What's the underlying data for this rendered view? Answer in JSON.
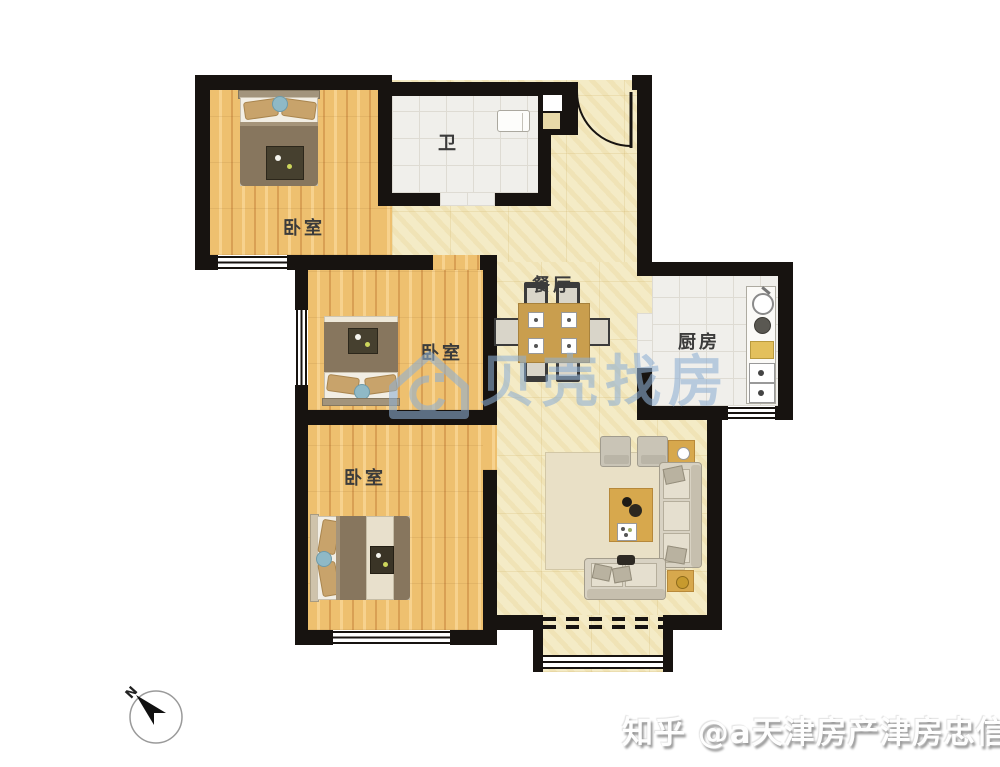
{
  "title": "三室户型图",
  "rooms": {
    "bedroom_top": {
      "label": "卧室"
    },
    "bedroom_mid": {
      "label": "卧室"
    },
    "bedroom_bottom": {
      "label": "卧室"
    },
    "bathroom": {
      "label": "卫"
    },
    "dining": {
      "label": "餐厅"
    },
    "kitchen": {
      "label": "厨房"
    }
  },
  "watermarks": {
    "center_logo_text": "贝壳找房",
    "bottom_right": "知乎 @a天津房产津房忠信庄"
  },
  "compass": {
    "label": "N"
  },
  "colors": {
    "wall": "#171310",
    "pale": "#f4ebc6",
    "wood": "#eec06f",
    "woodLight": "#f7d28e",
    "woodDark": "#d9a054",
    "tile": "#f0efeb",
    "tileLine": "#dedbd3",
    "label": "#3b3b3b",
    "wmBlue": "#8fb0d4",
    "rug": "#e9e0c6",
    "sofa": "#d8d2c3",
    "cushion": "#e5dfcf",
    "tableWood": "#d7a84d",
    "blanket": "#87765e",
    "sheet": "#f2eee4",
    "pillow": "#c8a36b",
    "pillowBlue": "#8fb9c6"
  }
}
